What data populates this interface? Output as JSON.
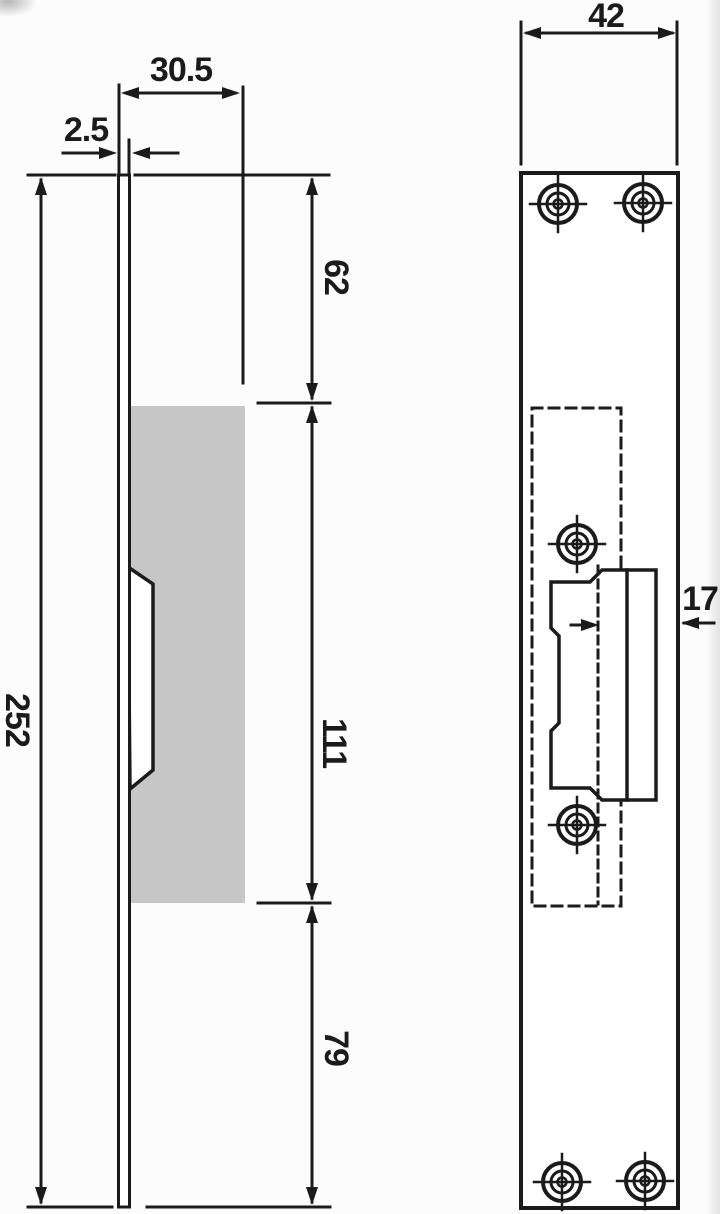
{
  "drawing": {
    "title": "Strike plate technical drawing, side and front views"
  },
  "side_view": {
    "label": "side view",
    "dims": {
      "plate_thickness": "2.5",
      "body_depth": "30.5",
      "plate_height": "252",
      "top_section": "62",
      "body_section": "111",
      "bottom_section": "79"
    }
  },
  "front_view": {
    "label": "front view",
    "dims": {
      "plate_width": "42",
      "keeper_offset": "17"
    }
  },
  "style": {
    "line_color": "#1b1b1b",
    "shade_color": "#c6c6c6",
    "paper_color": "#fcfcfc"
  }
}
